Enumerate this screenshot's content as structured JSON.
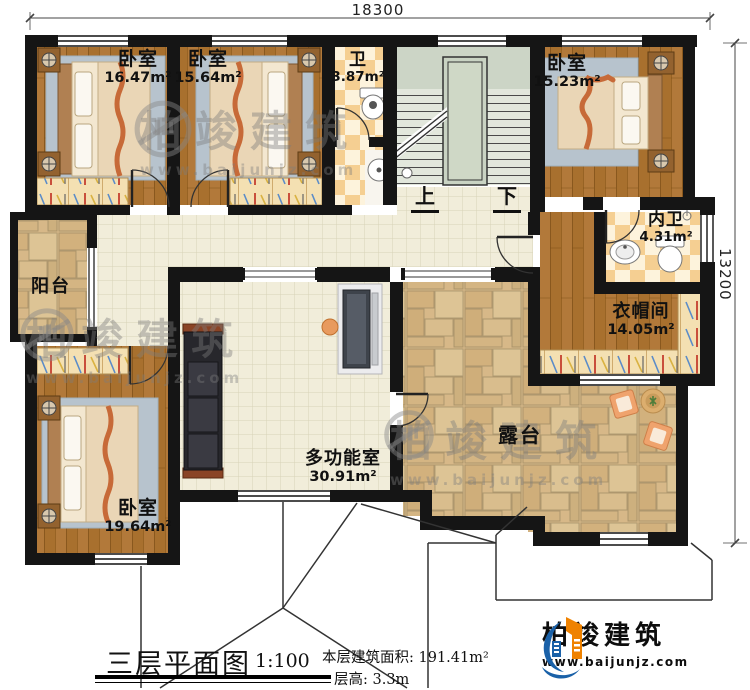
{
  "dimensions": {
    "top_width": "18300",
    "right_height": "13200"
  },
  "rooms": [
    {
      "id": "bedroom-top-left",
      "name": "卧室",
      "area": "16.47m²"
    },
    {
      "id": "bedroom-top-mid",
      "name": "卧室",
      "area": "15.64m²"
    },
    {
      "id": "bathroom",
      "name": "卫",
      "area": "3.87m²"
    },
    {
      "id": "bedroom-top-right",
      "name": "卧室",
      "area": "15.23m²"
    },
    {
      "id": "ensuite-bathroom",
      "name": "内卫",
      "area": "4.31m²"
    },
    {
      "id": "cloakroom",
      "name": "衣帽间",
      "area": "14.05m²"
    },
    {
      "id": "balcony",
      "name": "阳台",
      "area": ""
    },
    {
      "id": "bedroom-bottom-left",
      "name": "卧室",
      "area": "19.64m²"
    },
    {
      "id": "multifunction-room",
      "name": "多功能室",
      "area": "30.91m²"
    },
    {
      "id": "terrace",
      "name": "露台",
      "area": ""
    }
  ],
  "stairs": {
    "up": "上",
    "down": "下"
  },
  "title_block": {
    "plan_title": "三层平面图",
    "scale": "1:100",
    "floor_area_label": "本层建筑面积:",
    "floor_area_value": "191.41m²",
    "floor_height_label": "层高:",
    "floor_height_value": "3.3m"
  },
  "logo": {
    "company": "柏竣建筑",
    "website": "www.baijunjz.com"
  },
  "watermark": {
    "company": "柏竣建筑",
    "website": "www.baijunjz.com"
  },
  "colors": {
    "wall": "#151515",
    "wood": "#a8702e",
    "corridor_tile": "#f1edda",
    "checker_dark": "#f5cf92",
    "checker_light": "#fdf3dc",
    "stone": "#d7b888",
    "stair": "#e2e7dc",
    "logo_blue": "#1a61a8",
    "logo_orange": "#ef8200"
  }
}
